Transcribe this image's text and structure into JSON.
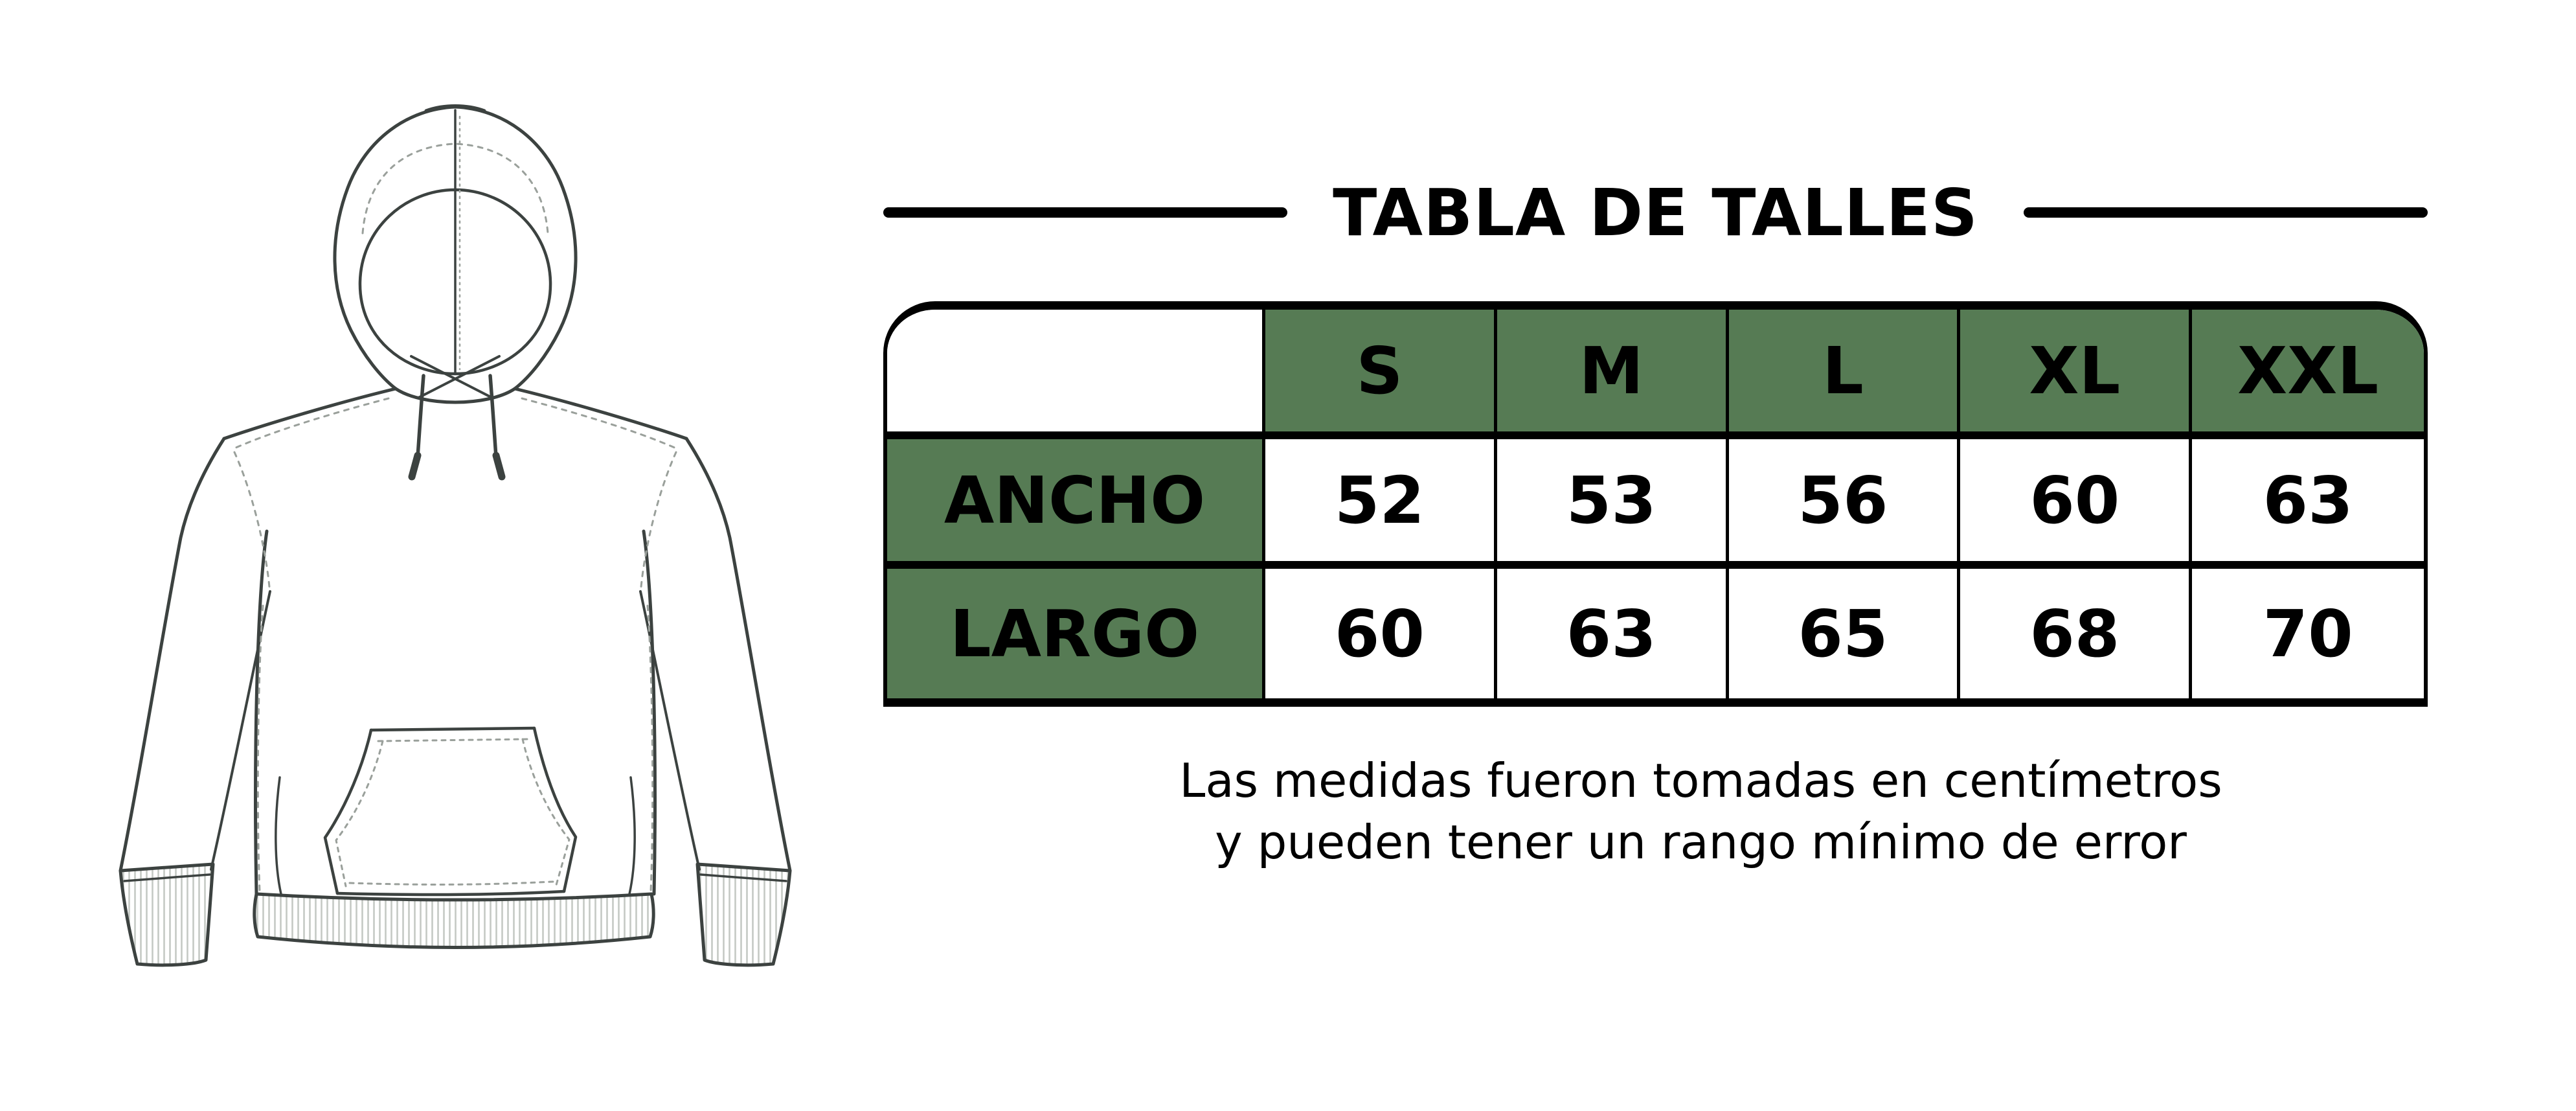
{
  "title": "TABLA DE TALLES",
  "illustration": {
    "name": "hoodie-front-flat-sketch"
  },
  "table": {
    "corner_label": "",
    "sizes": [
      "S",
      "M",
      "L",
      "XL",
      "XXL"
    ],
    "rows": [
      {
        "label": "ANCHO",
        "values": [
          "52",
          "53",
          "56",
          "60",
          "63"
        ]
      },
      {
        "label": "LARGO",
        "values": [
          "60",
          "63",
          "65",
          "68",
          "70"
        ]
      }
    ]
  },
  "footnote": {
    "line1": "Las medidas fueron tomadas en centímetros",
    "line2": "y pueden tener un rango mínimo de error"
  },
  "colors": {
    "header_green": "#567b54",
    "border": "#000000",
    "background": "#ffffff",
    "line_art": "#3c4240"
  },
  "chart_data": {
    "type": "table",
    "title": "TABLA DE TALLES",
    "columns": [
      "",
      "S",
      "M",
      "L",
      "XL",
      "XXL"
    ],
    "rows": [
      [
        "ANCHO",
        52,
        53,
        56,
        60,
        63
      ],
      [
        "LARGO",
        60,
        63,
        65,
        68,
        70
      ]
    ],
    "units": "centímetros",
    "notes": "Las medidas fueron tomadas en centímetros y pueden tener un rango mínimo de error"
  }
}
